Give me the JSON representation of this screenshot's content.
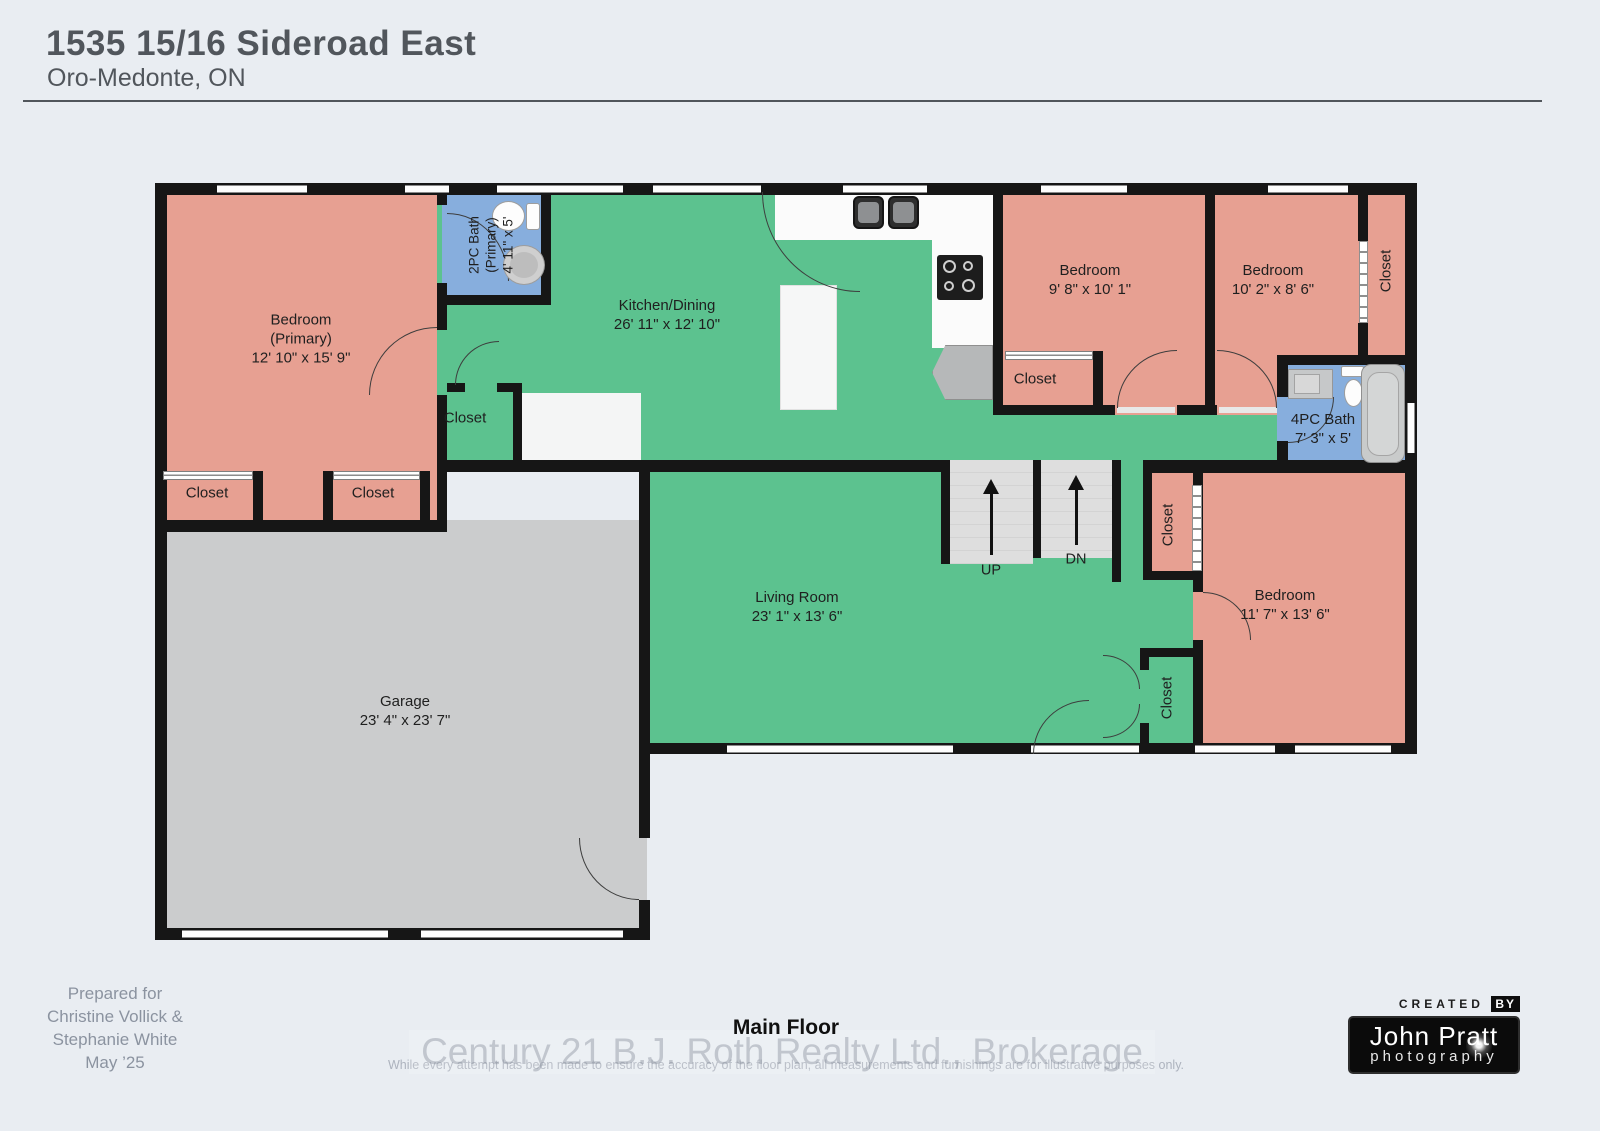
{
  "header": {
    "title": "1535 15/16 Sideroad East",
    "subtitle": "Oro-Medonte, ON"
  },
  "plan": {
    "rooms": {
      "primary_bedroom": {
        "name": "Bedroom",
        "qualifier": "(Primary)",
        "dims": "12' 10\" x 15' 9\""
      },
      "primary_bath": {
        "name": "2PC Bath",
        "qualifier": "(Primary)",
        "dims": "4' 11\" x 5'"
      },
      "kitchen_dining": {
        "name": "Kitchen/Dining",
        "dims": "26' 11\" x 12' 10\""
      },
      "bedroom_2": {
        "name": "Bedroom",
        "dims": "9' 8\" x 10' 1\""
      },
      "bedroom_3": {
        "name": "Bedroom",
        "dims": "10' 2\" x 8' 6\""
      },
      "main_bath": {
        "name": "4PC Bath",
        "dims": "7' 3\" x 5'"
      },
      "living_room": {
        "name": "Living Room",
        "dims": "23' 1\" x 13' 6\""
      },
      "bedroom_4": {
        "name": "Bedroom",
        "dims": "11' 7\" x 13' 6\""
      },
      "garage": {
        "name": "Garage",
        "dims": "23' 4\" x 23' 7\""
      }
    },
    "labels": {
      "closet": "Closet",
      "stairs_up": "UP",
      "stairs_down": "DN"
    }
  },
  "footer": {
    "prepared": {
      "line1": "Prepared for",
      "line2": "Christine Vollick &",
      "line3": "Stephanie White",
      "line4": "May ’25"
    },
    "floor_label": "Main Floor",
    "watermark": "Century 21 B.J. Roth Realty Ltd., Brokerage",
    "disclaimer": "While every attempt has been made to ensure the accuracy of the floor plan, all measurements and furnishings are for illustrative purposes only.",
    "logo": {
      "created": "CREATED",
      "by": "BY",
      "name": "John Pratt",
      "word": "photography"
    }
  },
  "colors": {
    "bedroom": "#E7A092",
    "living_area": "#5CC28F",
    "bathroom": "#87AEDD",
    "garage": "#CBCCCD",
    "wall": "#161616"
  }
}
